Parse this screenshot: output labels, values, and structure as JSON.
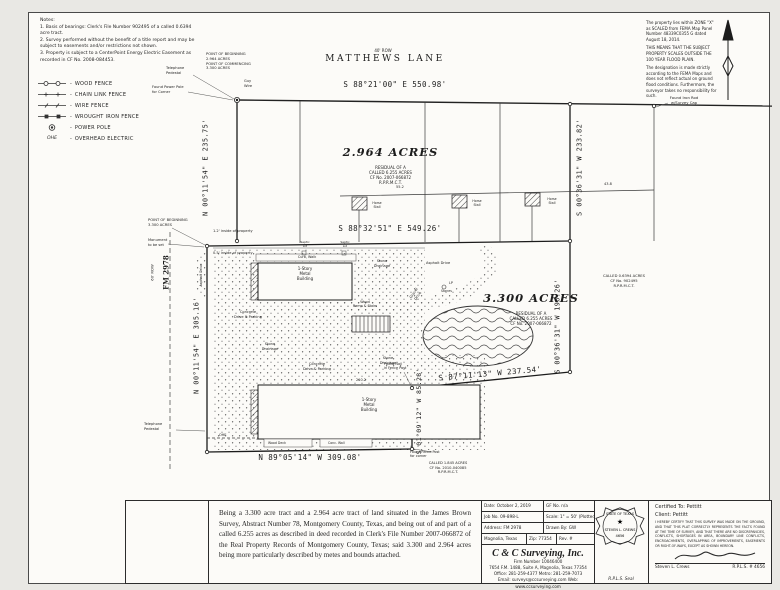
{
  "notes": {
    "title": "Notes:",
    "items": [
      "1. Basis of bearings: Clerk's File Number 902495 of a called 0.6394 acre tract.",
      "2. Survey performed without the benefit of a title report and may be subject to easements and/or restrictions not shown.",
      "3. Property is subject to a CenterPoint Energy Electric Easement as recorded in CF No. 2008-084453."
    ]
  },
  "legend": {
    "dash": "-",
    "items": [
      {
        "label": "WOOD FENCE"
      },
      {
        "label": "CHAIN LINK FENCE"
      },
      {
        "label": "WIRE FENCE"
      },
      {
        "label": "WROUGHT IRON FENCE"
      },
      {
        "label": "POWER POLE"
      },
      {
        "sym": "OHE",
        "label": "OVERHEAD ELECTRIC"
      }
    ]
  },
  "flood_note": {
    "p1": "The property lies within ZONE \"X\" as SCALED from FEMA Map Panel Number 48339C0355 G dated August 18, 2014.",
    "p2": "THIS MEANS THAT THE SUBJECT PROPERTY SCALES OUTSIDE THE 100 YEAR FLOOD PLAIN.",
    "p3": "The designation is made strictly according to the FEMA Maps and does not reflect actual on ground flood conditions. Furthermore, the surveyor takes no responsibility for such."
  },
  "roads": {
    "matthews_row": "40' ROW",
    "matthews_name": "MATTHEWS LANE",
    "fm_row": "60' ROW",
    "fm_name": "FM 2978"
  },
  "bearings": {
    "matthews": "S 88°21'00\" E  550.98'",
    "west_upper": "N 00°11'54\" E  235.75'",
    "east_upper": "S 00°36'31\" W  233.82'",
    "mid": "S 88°32'51\" E  549.26'",
    "west_lower": "N 00°11'54\" E  305.16'",
    "east_lower": "S 00°36'31\" W  196.26'",
    "southeast": "S 87°11'13\" W  237.54'",
    "jog": "S 01°09'12\" W  85.28'",
    "south": "N 89°05'14\" W  309.08'"
  },
  "tract1": {
    "area": "2.964 ACRES",
    "sub": "RESIDUAL OF A\nCALLED 6.255 ACRES\nCF No. 2007-066872\nR.P.R.M.C.T."
  },
  "tract2": {
    "area": "3.300 ACRES",
    "sub": "RESIDUAL OF A\nCALLED 6.255 ACRES\nCF No. 2007-066872"
  },
  "adjoiners": {
    "east": "CALLED 0.6394 ACRES\nCF No. 902495\nR.P.R.M.C.T.",
    "south": "CALLED 1.845 ACRES\nCF No. 2010-040085\nR.P.R.M.C.T."
  },
  "site": {
    "pob_2964": "POINT OF BEGINNING\n2.964 ACRES\nPOINT OF COMMENCING\n3.300 ACRES",
    "pob_3300": "POINT OF BEGINNING\n3.300 ACRES",
    "monument": "Monument\nto be set",
    "power_pole": "Found Power Pole\nfor Corner",
    "telephone_pedestal": "Telephone\nPedestal",
    "guy_wire": "Guy\nWire",
    "found_iron_rod": "Found Iron Rod\nw/Survey Cap",
    "fence_note_1": "1.2' inside of property",
    "fence_note_2": "0.5' inside of property",
    "curb_walk": "Curb, Walk",
    "building": "1-Story\nMetal\nBuilding",
    "ramp": "Wood\nRamp & Stairs",
    "horse_stall": "Horse\nStall",
    "septic_lid": "Septic\nLid",
    "lp": "LP",
    "stones": "Stones",
    "stone_drainage": "Stone\nDrainage",
    "concrete_drive": "Concrete\nDrive & Parking",
    "gravel_drive": "Gravel\nDrive",
    "asphalt_drive": "Asphalt Drive",
    "found_nail": "Found Nail\nin Fence Post",
    "found_fence_post": "Found Fence Post\nfor corner",
    "wood_deck": "Wood Deck",
    "conc_wall": "Conc. Wall",
    "ohe": "OHE",
    "dim_210": "210.2",
    "dim_55": "55.2",
    "dim_43": "43.8"
  },
  "description": {
    "text": "Being a 3.300 acre tract and a 2.964 acre tract of land situated in the James Brown Survey, Abstract Number 78, Montgomery County, Texas, and being out of and part of a called 6.255 acres as described in deed recorded in Clerk's File Number 2007-066872 of the Real Property Records of Montgomery County, Texas; said 3.300 and 2.964 acres being more particularly described by metes and bounds attached."
  },
  "title_block": {
    "row1a": "Date: October 2, 2019",
    "row1b": "GF No. n/a",
    "row2a": "Job No. 09-898-L",
    "row2b": "Scale: 1\" = 50' (Plotted)",
    "row3a": "Address: FM 2978",
    "row3b": "Drawn By: GW",
    "row4a": "Magnolia, Texas",
    "row4b": "Zip: 77354",
    "row4c": "Rev. #",
    "company": "C & C Surveying, Inc.",
    "firm": "Firm Number 10046400",
    "address": "7654 F.M. 1488, Suite A, Magnolia, Texas 77354",
    "phones": "Office: 281-259-4377   Metro: 281-259-7073",
    "contact": "Email: surveys@ccsurveying.com   Web: www.ccsurveying.com",
    "seal_caption": "R.P.L.S. Seal",
    "seal_state": "STATE OF TEXAS",
    "seal_name": "STEVEN L. CREWS",
    "seal_num": "4656",
    "seal_star": "★"
  },
  "certification": {
    "certified_to": "Certified To: Pettitt",
    "client": "Client: Pettitt",
    "body": "I HEREBY CERTIFY THAT THIS SURVEY WAS MADE ON THE GROUND, AND THAT THIS PLAT CORRECTLY REPRESENTS THE FACTS FOUND AT THE TIME OF SURVEY, AND THAT THERE ARE NO DISCREPANCIES, CONFLICTS, SHORTAGES IN AREA, BOUNDARY LINE CONFLICTS, ENCROACHMENTS, OVERLAPPING OF IMPROVEMENTS, EASEMENTS OR RIGHT-OF-WAYS, EXCEPT AS SHOWN HEREON.",
    "signer": "Steven L. Crews",
    "rpls": "R.P.L.S. # 4656"
  }
}
